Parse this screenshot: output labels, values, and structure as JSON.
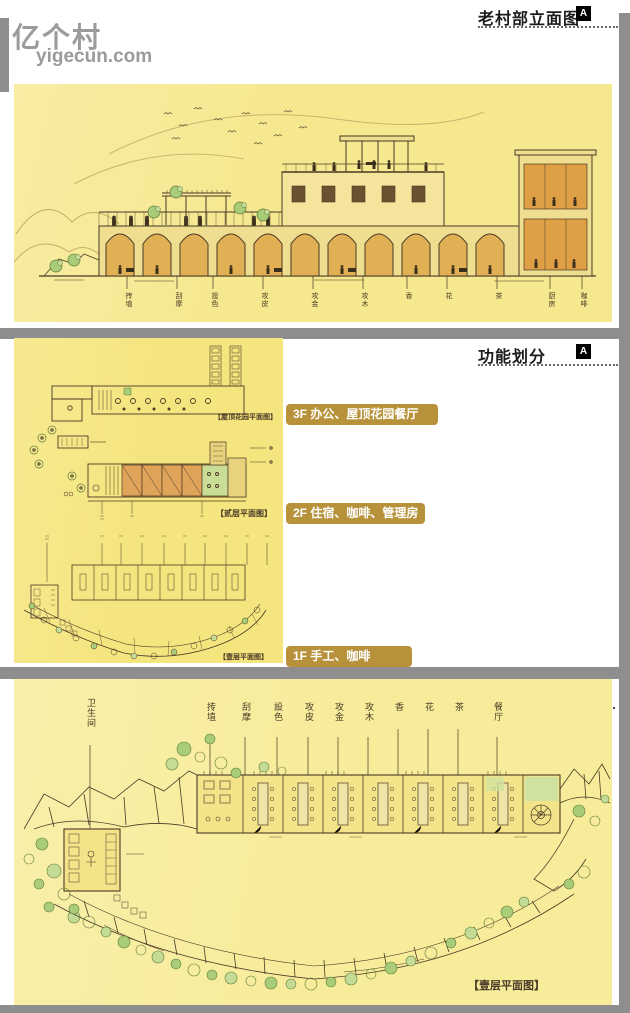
{
  "watermark": {
    "title": "亿个村",
    "domain": "yigecun.com"
  },
  "panels": {
    "elevation": {
      "header": "老村部立面图",
      "badge": "A",
      "room_labels": [
        "抟埴",
        "刮摩",
        "設色",
        "攻皮",
        "攻金",
        "攻木",
        "香",
        "花",
        "茶",
        "厨房",
        "咖啡"
      ]
    },
    "functions": {
      "header": "功能划分",
      "badge": "A",
      "floors": [
        {
          "label": "3F 办公、屋顶花园餐厅",
          "caption": "【屋顶花园平面图】"
        },
        {
          "label": "2F 住宿、咖啡、管理房",
          "caption": "【贰层平面图】"
        },
        {
          "label": "1F 手工、咖啡",
          "caption": "【壹层平面图】"
        }
      ]
    },
    "plan": {
      "header": "老村部1F平面图",
      "badge": "A",
      "room_labels": [
        "卫生间",
        "抟埴",
        "刮摩",
        "設色",
        "攻皮",
        "攻金",
        "攻木",
        "香",
        "花",
        "茶",
        "餐厅"
      ],
      "caption": "【壹层平面图】"
    }
  },
  "colors": {
    "panel_yellow_top": "#f6e88e",
    "panel_yellow_mid": "#f5e57e",
    "panel_yellow_bottom": "#f7ec99",
    "divider_gray": "#8e8e8e",
    "accent_gold": "#b8923b",
    "sketch_ink": "#4a3a26",
    "watermark_gray": "#9b9b9b"
  }
}
